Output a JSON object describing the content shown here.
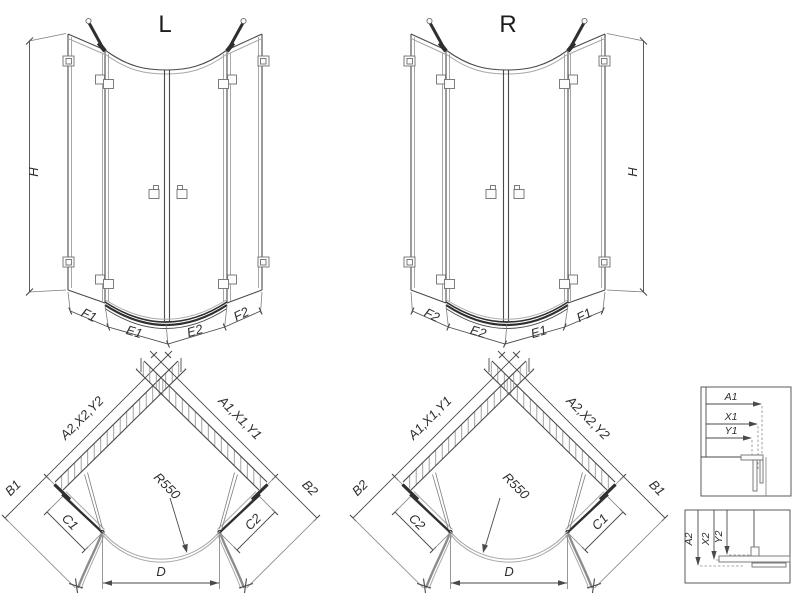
{
  "drawing": {
    "elevation_left": {
      "title": "L",
      "height": "H",
      "dims": [
        "F1",
        "E1",
        "E2",
        "F2"
      ]
    },
    "elevation_right": {
      "title": "R",
      "height": "H",
      "dims": [
        "F2",
        "E2",
        "E1",
        "F1"
      ]
    },
    "plan_left": {
      "wall_left": "A2,X2,Y2",
      "wall_right": "A1,X1,Y1",
      "b_left": "B1",
      "b_right": "B2",
      "c_left": "C1",
      "c_right": "C2",
      "radius": "R550",
      "width": "D"
    },
    "plan_right": {
      "wall_left": "A1,X1,Y1",
      "wall_right": "A2,X2,Y2",
      "b_left": "B2",
      "b_right": "B1",
      "c_left": "C2",
      "c_right": "C1",
      "radius": "R550",
      "width": "D"
    },
    "detail_top": {
      "labels": [
        "A1",
        "X1",
        "Y1"
      ]
    },
    "detail_bottom": {
      "labels": [
        "A2",
        "X2",
        "Y2"
      ]
    }
  },
  "colors": {
    "line": "#4a4a4a",
    "light_line": "#a8a8a8",
    "dark": "#2f2f2f",
    "hatch": "#999999",
    "text": "#2e2e2e",
    "background": "#ffffff"
  }
}
